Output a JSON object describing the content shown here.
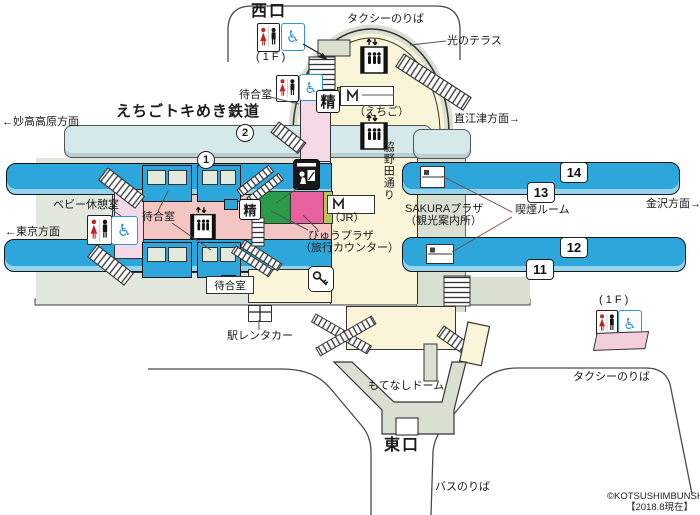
{
  "colors": {
    "platform_blue": "#2da6db",
    "etr_platform_blue": "#d6e9ea",
    "concourse_pink": "#f4c6c3",
    "room_pink": "#f6d9e6",
    "building_yellow": "#faf4d9",
    "walkway_grey": "#d9e0d1",
    "walkway_grey_light": "#e3e8dd",
    "midori_green": "#2a9c48",
    "viewplaza_magenta": "#e6629e",
    "olive_strip": "#b8c455",
    "machine_green": "#7cb342",
    "wheelchair_blue": "#2e97d8"
  },
  "labels": {
    "west_exit": "西口",
    "taxi_west": "タクシーのりば",
    "floor_1f_west": "( 1 F )",
    "hikari_terrace": "光のテラス",
    "waiting_room_top": "待合室",
    "fare_adjust_top": "精",
    "machine_echigo": "（えちご）",
    "etr_line": "えちごトキめき鉄道",
    "dir_myoko": "←妙高高原方面",
    "dir_naoetsu": "直江津方面→",
    "street_wakinoda": "脇野田通り",
    "baby_room": "ベビー休憩室",
    "dir_tokyo": "←東京方面",
    "waiting_room_mid": "待合室",
    "fare_adjust_mid": "精",
    "machine_jr": "（JR）",
    "view_plaza_line1": "びゅうプラザ",
    "view_plaza_line2": "（旅行カウンター）",
    "sakura_line1": "SAKURAプラザ",
    "sakura_line2": "（観光案内所）",
    "smoking_room": "喫煙ルーム",
    "dir_kanazawa": "金沢方面→",
    "waiting_room_south": "待合室",
    "rentacar": "駅レンタカー",
    "motenashi_dome": "もてなしドーム",
    "east_exit": "東口",
    "bus_stop": "バスのりば",
    "taxi_east": "タクシーのりば",
    "floor_1f_east": "( 1 F )",
    "copyright": "©KOTSUSHIMBUNSHA",
    "as_of": "【2018.8現在】"
  },
  "platforms": {
    "p1": "1",
    "p2": "2",
    "n11": "11",
    "n12": "12",
    "n13": "13",
    "n14": "14"
  }
}
